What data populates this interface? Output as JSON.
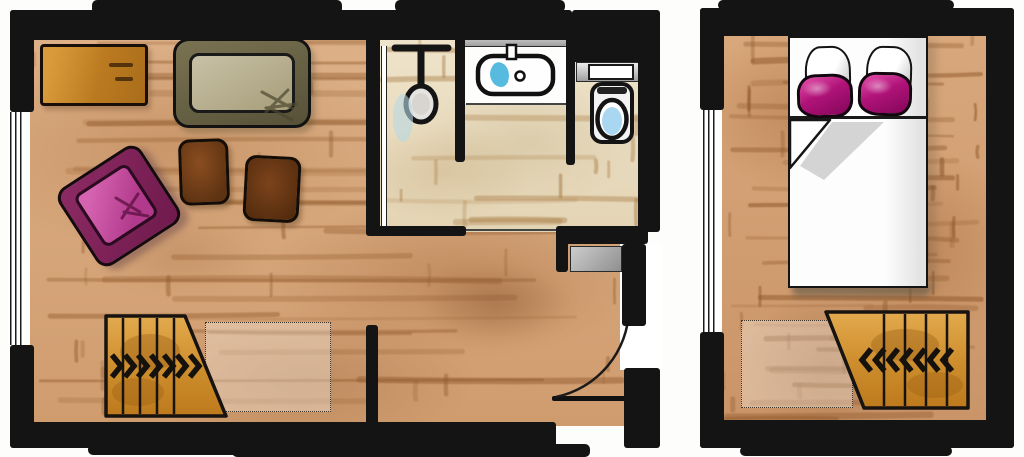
{
  "plan": {
    "kind": "hand-drawn watercolor floor plan",
    "units": [
      {
        "id": "left-unit",
        "rooms": [
          "living-room",
          "shower-room",
          "washbasin-room",
          "wc-room",
          "entry-hall",
          "staircase"
        ],
        "furniture": [
          "sideboard",
          "sofa",
          "coffee-table",
          "side-table",
          "armchair",
          "shower-head",
          "washbasin",
          "toilet",
          "entry-mat",
          "entry-door",
          "stairs"
        ]
      },
      {
        "id": "right-unit",
        "rooms": [
          "bedroom",
          "staircase"
        ],
        "furniture": [
          "double-bed",
          "white-pillows",
          "magenta-pillows",
          "folded-duvet",
          "stairs"
        ]
      }
    ]
  },
  "stairs": {
    "left": {
      "direction": "right",
      "chevron_count": 7,
      "tread_count": 4,
      "dotted_columns": 6
    },
    "right": {
      "direction": "left",
      "chevron_count": 7,
      "tread_count": 4,
      "dotted_columns": 5
    }
  },
  "windows": {
    "left_unit_line_count": 3,
    "right_unit_line_count": 4
  },
  "palette": {
    "wall": "#141414",
    "floor-wood": "#d5a67b",
    "floor-wood-stroke": "#8f5a2c",
    "floor-tile": "#e9ddc2",
    "floor-tile-stroke": "#a87a44",
    "furniture-orange": "#c8872f",
    "sofa-frame": "#6a6447",
    "sofa-cushion": "#b6ad8c",
    "stool-brown": "#6f3f1c",
    "accent-magenta": "#b01378",
    "accent-magenta-dark": "#7c1d58",
    "water-blue": "#45b4dc",
    "stair-wood": "#cf8f2e",
    "entry-mat-gray": "#b0aeab",
    "shadow-gray": "#c9c9c9"
  }
}
